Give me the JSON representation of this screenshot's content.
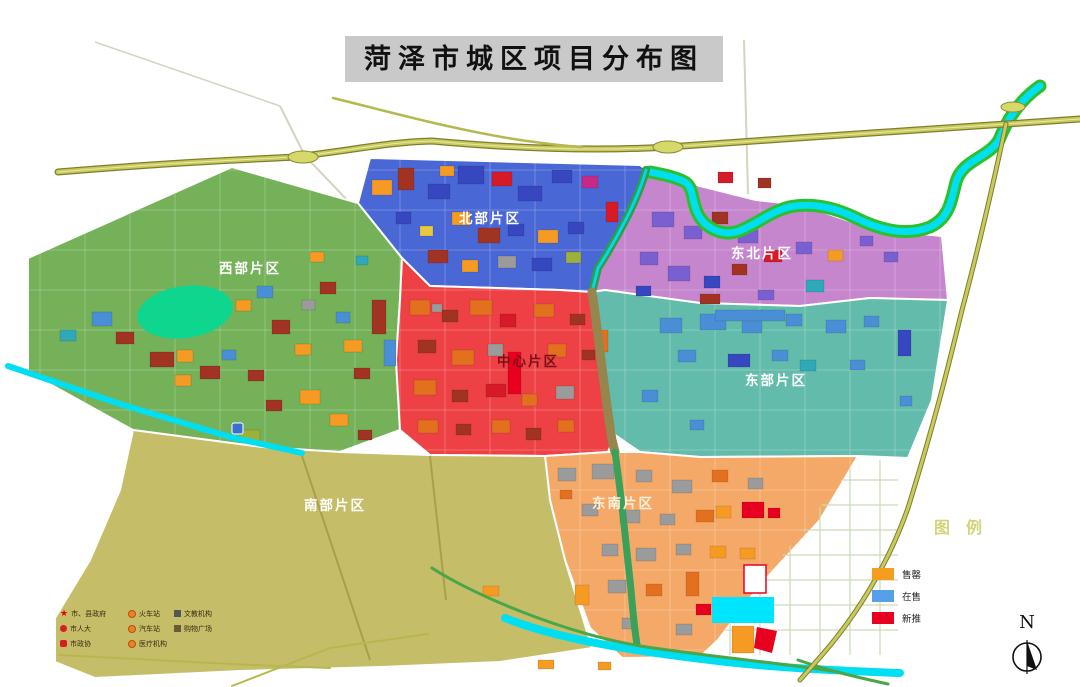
{
  "title": "菏泽市城区项目分布图",
  "districts": [
    {
      "id": "west",
      "name": "西部片区",
      "color": "#74b159",
      "label_color": "#ffffff",
      "label_x": 250,
      "label_y": 273
    },
    {
      "id": "north",
      "name": "北部片区",
      "color": "#4a67d6",
      "label_color": "#ffffff",
      "label_x": 490,
      "label_y": 223
    },
    {
      "id": "northeast",
      "name": "东北片区",
      "color": "#c686ce",
      "label_color": "#ffffff",
      "label_x": 762,
      "label_y": 258
    },
    {
      "id": "center",
      "name": "中心片区",
      "color": "#ee4145",
      "label_color": "#7a0f16",
      "label_x": 528,
      "label_y": 366
    },
    {
      "id": "east",
      "name": "东部片区",
      "color": "#63bcab",
      "label_color": "#ffffff",
      "label_x": 776,
      "label_y": 385
    },
    {
      "id": "southeast",
      "name": "东南片区",
      "color": "#f5a968",
      "label_color": "#fff0dc",
      "label_x": 623,
      "label_y": 508
    },
    {
      "id": "south",
      "name": "南部片区",
      "color": "#c6bd69",
      "label_color": "#ffffff",
      "label_x": 335,
      "label_y": 510
    }
  ],
  "legend": {
    "title": "图例",
    "title_color": "#d2d47c",
    "items": [
      {
        "label": "售罄",
        "color": "#f59d1e"
      },
      {
        "label": "在售",
        "color": "#55a0e8"
      },
      {
        "label": "新推",
        "color": "#e8001f"
      }
    ]
  },
  "mini_legend": {
    "columns": [
      {
        "items": [
          {
            "icon": "star",
            "label": "市、县政府"
          },
          {
            "icon": "emblem-round",
            "label": "市人大"
          },
          {
            "icon": "emblem-square",
            "label": "市政协"
          }
        ]
      },
      {
        "items": [
          {
            "icon": "train-station",
            "label": "火车站"
          },
          {
            "icon": "bus-station",
            "label": "汽车站"
          },
          {
            "icon": "hospital",
            "label": "医疗机构"
          }
        ]
      },
      {
        "items": [
          {
            "icon": "school",
            "label": "文教机构"
          },
          {
            "icon": "mall",
            "label": "购物广场"
          }
        ]
      }
    ]
  },
  "compass": {
    "label": "N"
  },
  "water": {
    "river_color": "#00dff2",
    "bank_color": "#2cc12c",
    "lake_color": "#0fd68e",
    "pond_color": "#00e5ff"
  },
  "roads": {
    "highway_fill": "#c9ca5e",
    "highway_casing": "#7d7f2a",
    "minor_color": "#b6b84e",
    "green_road": "#49a649"
  },
  "palette": {
    "p_dkred": "#a03322",
    "p_orange": "#f59a23",
    "p_orange2": "#e2701f",
    "p_blue": "#4a8fd6",
    "p_deepblue": "#3647c0",
    "p_crimson": "#d61a28",
    "p_red2": "#e8001f",
    "p_gray": "#9b9b9b",
    "p_violet": "#7a5fd0",
    "p_magenta": "#c42a86",
    "p_teal": "#2fa8b8",
    "p_green": "#9fb03a",
    "p_yellow": "#e8c93d",
    "p_cyan": "#00e5ff"
  }
}
